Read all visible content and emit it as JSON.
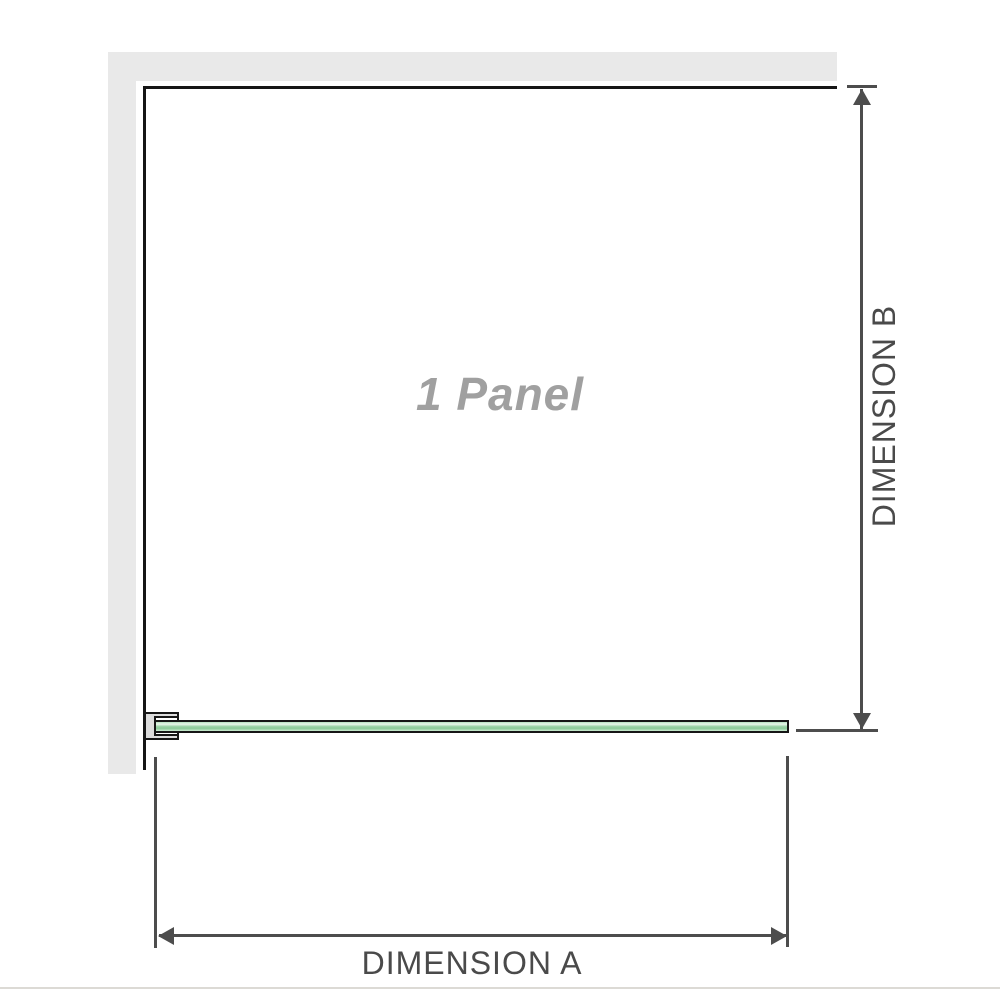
{
  "diagram": {
    "panel_label": "1 Panel",
    "dimension_a": {
      "label": "DIMENSION A"
    },
    "dimension_b": {
      "label": "DIMENSION B"
    },
    "colors": {
      "wall": "#e9e9e9",
      "panel_outline": "#161616",
      "glass_green_light": "#e9f7eb",
      "glass_green": "#98d1a4",
      "bracket_fill": "#dcdcdc",
      "dimension_line": "#4d4d4d",
      "dimension_label_text": "#4a4a4a",
      "panel_label_text": "#a0a0a0",
      "bottom_divider": "#dcdad5"
    }
  }
}
